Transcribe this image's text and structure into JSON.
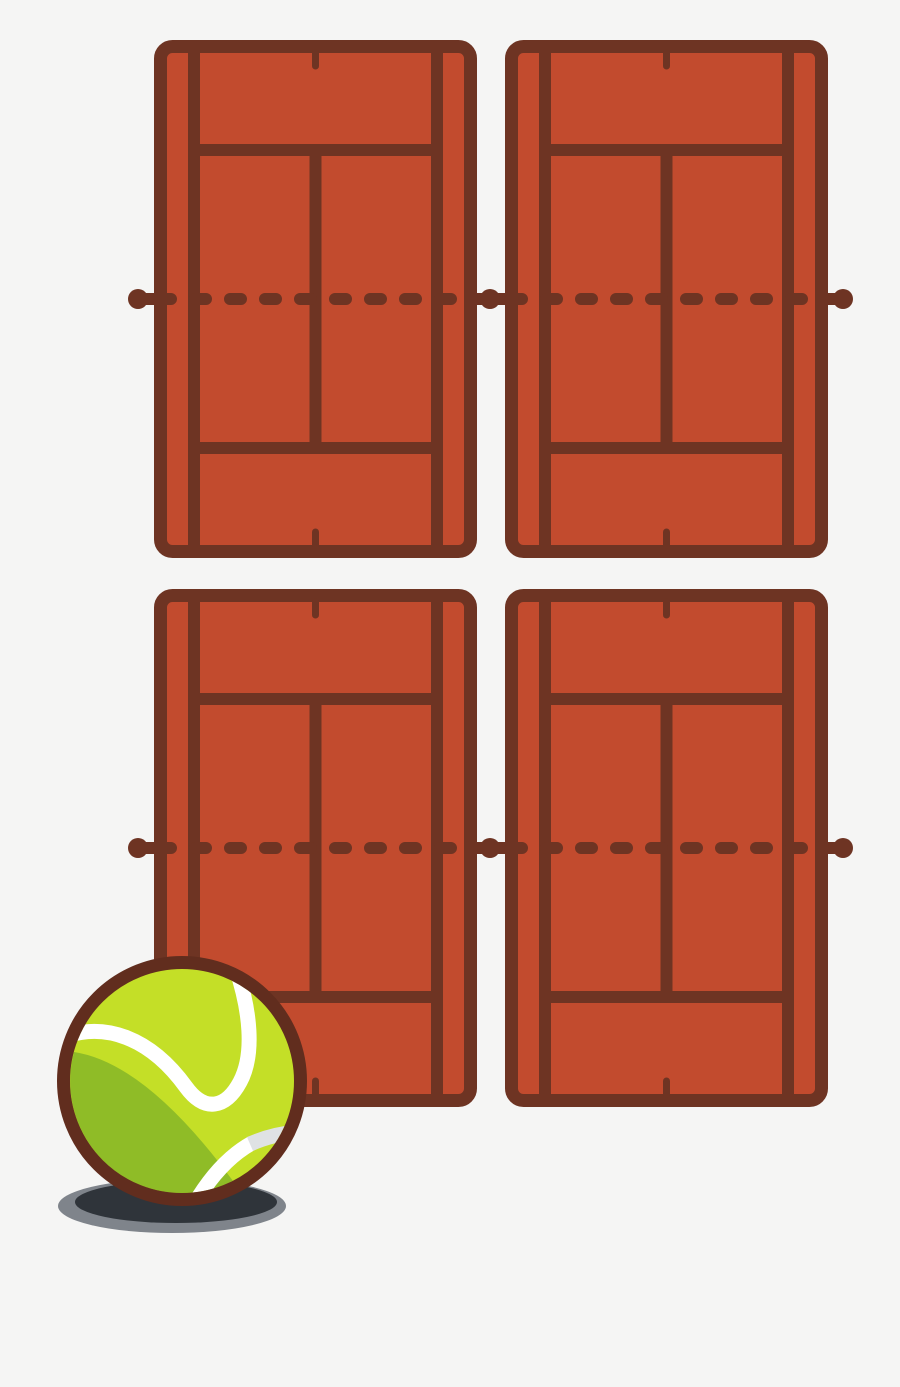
{
  "scene": {
    "kind": "tennis-courts-illustration",
    "background_color": "#f5f5f4",
    "canvas": {
      "width": 900,
      "height": 1387
    },
    "court_template": {
      "width": 323,
      "height": 518,
      "surface_color": "#c24b2e",
      "line_color": "#6e3423",
      "border_width": 13,
      "line_width": 12,
      "corner_radius": 12,
      "singles_line_x": [
        40,
        283
      ],
      "service_line_y": [
        110,
        408
      ],
      "center_line_x": 161.5,
      "center_mark": {
        "width": 7,
        "length": 13,
        "top_y": 13,
        "bottom_y": 505
      }
    },
    "courts": [
      {
        "id": "tennis-court-top-left",
        "x": 154,
        "y": 40
      },
      {
        "id": "tennis-court-top-right",
        "x": 505,
        "y": 40
      },
      {
        "id": "tennis-court-bottom-left",
        "x": 154,
        "y": 589
      },
      {
        "id": "tennis-court-bottom-right",
        "x": 505,
        "y": 589
      }
    ],
    "nets": {
      "color": "#6e3423",
      "line_width": 12,
      "dash_pattern": [
        11,
        24
      ],
      "post_radius": 10,
      "rows": [
        {
          "y": 299,
          "posts_x": [
            138,
            490,
            843
          ],
          "solid_spans": [
            [
              138,
              158
            ],
            [
              473,
              509
            ],
            [
              824,
              843
            ]
          ],
          "dashed_spans": [
            [
              160,
              473
            ],
            [
              511,
              824
            ]
          ]
        },
        {
          "y": 848,
          "posts_x": [
            138,
            490,
            843
          ],
          "solid_spans": [
            [
              138,
              158
            ],
            [
              473,
              509
            ],
            [
              824,
              843
            ]
          ],
          "dashed_spans": [
            [
              160,
              473
            ],
            [
              511,
              824
            ]
          ]
        }
      ]
    },
    "ball": {
      "cx": 182,
      "cy": 1081,
      "outer_radius": 125,
      "inner_radius": 112,
      "outline_width": 13,
      "outline_color": "#612d1e",
      "fill_color": "#c4df27",
      "shade_color": "#8fbc27",
      "seam_color": "#ffffff",
      "seam_shade_color": "#dfe2e4",
      "seam_width": 15,
      "shade_path": "M 74 1052 A 112 112 0 0 0 233 1181 Q 146 1063 74 1052 Z",
      "seam_main_path": "M 56 1040 C 105 1018 152 1040 186 1087 C 205 1113 226 1108 240 1082 C 255 1054 250 1010 236 968",
      "seam_lower_white_path": "M 192 1208 Q 218 1162 252 1143",
      "seam_lower_shade_path": "M 250 1144 Q 275 1133 300 1132",
      "shadow": {
        "outer_color": "#7f848b",
        "inner_color": "#2f343a",
        "outer_ellipse": {
          "cx": 172,
          "cy": 1206,
          "rx": 114,
          "ry": 27
        },
        "inner_ellipse": {
          "cx": 176,
          "cy": 1202,
          "rx": 101,
          "ry": 21
        }
      }
    }
  }
}
